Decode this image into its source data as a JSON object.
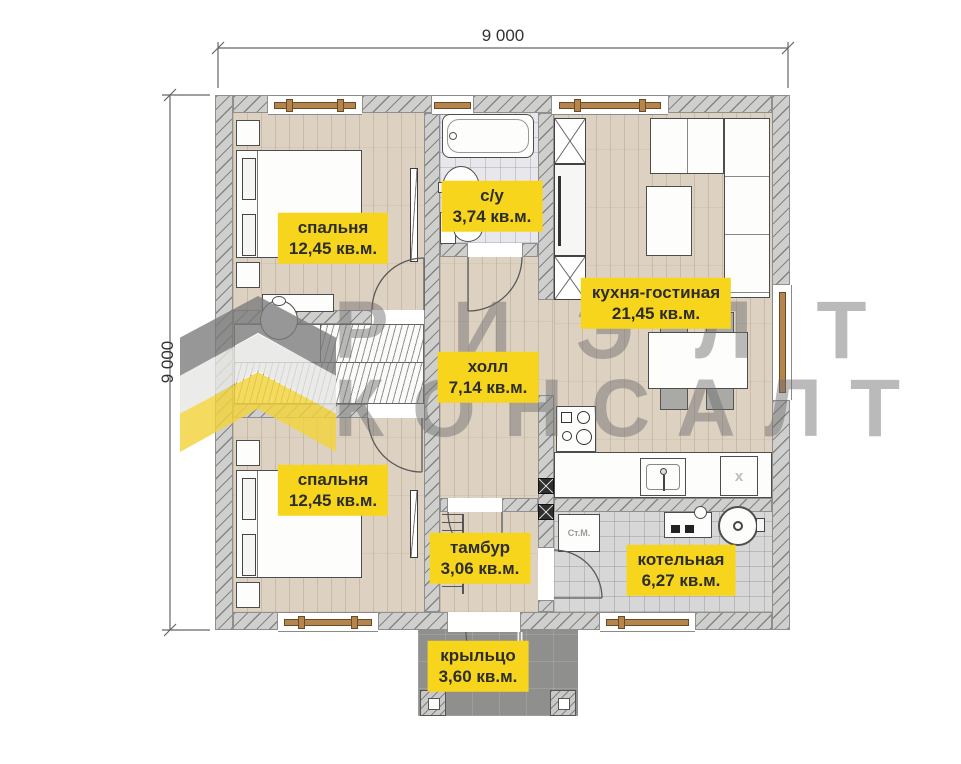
{
  "plan": {
    "type": "floor-plan",
    "units": "mm"
  },
  "dimensions": {
    "top": "9 000",
    "left": "9 000"
  },
  "watermark": {
    "word1": "РИЭЛТ",
    "word2": "КОНСАЛТ"
  },
  "rooms": [
    {
      "key": "bedroom-top",
      "name": "спальня",
      "area": "12,45 кв.м."
    },
    {
      "key": "bathroom",
      "name": "с/у",
      "area": "3,74 кв.м."
    },
    {
      "key": "kitchen-living",
      "name": "кухня-гостиная",
      "area": "21,45 кв.м."
    },
    {
      "key": "hall",
      "name": "холл",
      "area": "7,14 кв.м."
    },
    {
      "key": "bedroom-bottom",
      "name": "спальня",
      "area": "12,45 кв.м."
    },
    {
      "key": "vestibule",
      "name": "тамбур",
      "area": "3,06 кв.м."
    },
    {
      "key": "boiler-room",
      "name": "котельная",
      "area": "6,27 кв.м."
    },
    {
      "key": "porch",
      "name": "крыльцо",
      "area": "3,60 кв.м."
    }
  ],
  "fixtures": {
    "washing_machine": "Ст.М.",
    "cabinet_mark": "x"
  },
  "colors": {
    "label_bg": "#f7d51d",
    "wall": "#cfcfcd",
    "floor_wood": "#ddd2c2",
    "floor_tile": "#e8e8ec",
    "floor_boiler": "#d7d7d7",
    "porch": "#8f8f8d",
    "window_frame": "#b5854e",
    "logo_yellow": "#f2d33c",
    "watermark_gray": "rgba(110,110,110,0.48)"
  }
}
